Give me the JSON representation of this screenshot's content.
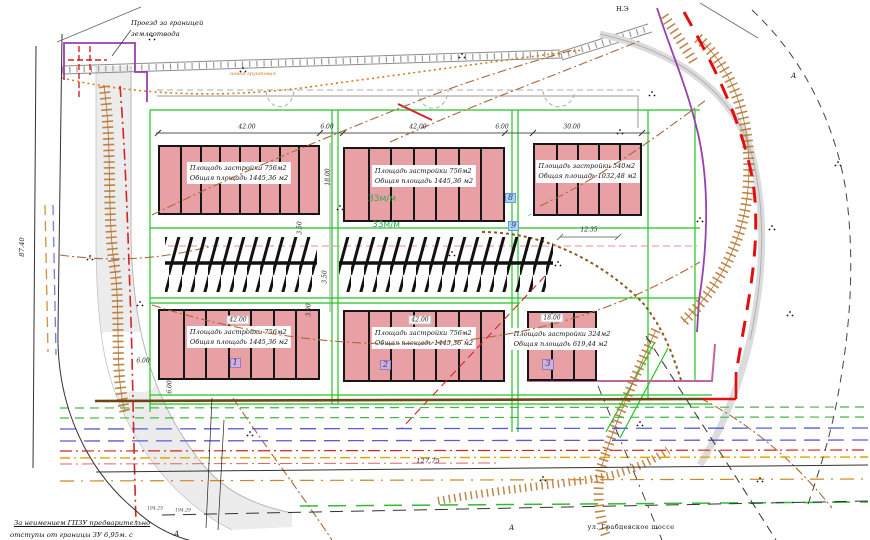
{
  "labels": {
    "top_left_note_line1": "Проезд за границей",
    "top_left_note_line2": "землеотвода",
    "bottom_left_note_line1": "За неимением ГПЗУ предварительно",
    "bottom_left_note_line2": "отступы от границы ЗУ 6,95м. с",
    "street": "ул. Грабцевское шоссе",
    "parking_capacity_1": "33м/м",
    "parking_capacity_2": "33м/м",
    "new_road": "новая грунтовая",
    "ne_marker": "Н.Э",
    "marker_a1": "А",
    "marker_a2": "А",
    "marker_a3": "А",
    "node_badge_8": "8",
    "node_badge_9": "9"
  },
  "buildings": [
    {
      "id": "top-left",
      "x": 158,
      "y": 145,
      "w": 162,
      "h": 70,
      "sections": 8,
      "badge": "",
      "badge_left_pct": 0,
      "line1": "Площадь застройки 756м2",
      "line2": "Общая площадь 1445,36 м2"
    },
    {
      "id": "top-middle",
      "x": 343,
      "y": 147,
      "w": 162,
      "h": 75,
      "sections": 7,
      "badge": "",
      "badge_left_pct": 0,
      "line1": "Площадь застройки 756м2",
      "line2": "Общая площадь 1445,36 м2"
    },
    {
      "id": "top-right",
      "x": 533,
      "y": 143,
      "w": 109,
      "h": 73,
      "sections": 5,
      "badge": "",
      "badge_left_pct": 0,
      "line1": "Площадь застройки 540м2",
      "line2": "Общая площадь 1032,48 м2"
    },
    {
      "id": "bottom-left",
      "x": 158,
      "y": 309,
      "w": 162,
      "h": 71,
      "sections": 7,
      "badge": "1",
      "badge_left_pct": 44,
      "line1": "Площадь застройки 756м2",
      "line2": "Общая площадь 1445,36 м2"
    },
    {
      "id": "bottom-middle",
      "x": 343,
      "y": 310,
      "w": 162,
      "h": 72,
      "sections": 7,
      "badge": "2",
      "badge_left_pct": 22,
      "line1": "Площадь застройки 756м2",
      "line2": "Общая площадь 1445,36 м2"
    },
    {
      "id": "bottom-right",
      "x": 527,
      "y": 311,
      "w": 70,
      "h": 70,
      "sections": 3,
      "badge": "3",
      "badge_left_pct": 20,
      "line1": "Площадь застройки 324м2",
      "line2": "Общая площадь 619,44 м2"
    }
  ],
  "dims": [
    {
      "text": "42.00",
      "x": 247,
      "y": 127,
      "cls": ""
    },
    {
      "text": "6.00",
      "x": 327,
      "y": 127,
      "cls": ""
    },
    {
      "text": "42.00",
      "x": 418,
      "y": 127,
      "cls": ""
    },
    {
      "text": "6.00",
      "x": 502,
      "y": 127,
      "cls": ""
    },
    {
      "text": "30.00",
      "x": 572,
      "y": 127,
      "cls": ""
    },
    {
      "text": "42.00",
      "x": 238,
      "y": 320,
      "cls": "box"
    },
    {
      "text": "42.00",
      "x": 420,
      "y": 320,
      "cls": "box"
    },
    {
      "text": "18.00",
      "x": 552,
      "y": 318,
      "cls": "box"
    },
    {
      "text": "12.35",
      "x": 589,
      "y": 230,
      "cls": ""
    },
    {
      "text": "18.00",
      "x": 328,
      "y": 177,
      "cls": "rot"
    },
    {
      "text": "3.50",
      "x": 300,
      "y": 228,
      "cls": "rot"
    },
    {
      "text": "3.50",
      "x": 325,
      "y": 277,
      "cls": "rot"
    },
    {
      "text": "3.00",
      "x": 309,
      "y": 310,
      "cls": "rot"
    },
    {
      "text": "6.00",
      "x": 143,
      "y": 361,
      "cls": ""
    },
    {
      "text": "6.00",
      "x": 170,
      "y": 387,
      "cls": "rot"
    },
    {
      "text": "87.40",
      "x": 22,
      "y": 247,
      "cls": "rot big"
    },
    {
      "text": "127.75",
      "x": 428,
      "y": 461,
      "cls": "big"
    },
    {
      "text": "194.25",
      "x": 155,
      "y": 509,
      "cls": "tiny"
    },
    {
      "text": "194.29",
      "x": 183,
      "y": 511,
      "cls": "tiny"
    }
  ],
  "colors": {
    "building_fill": "#e9a0a5",
    "boundary_green": "#22c522",
    "boundary_purple": "#9a3fb0",
    "boundary_pink": "#c2679e",
    "slope_orange": "#b5722d",
    "contour_brown": "#a9683a",
    "utility_blue": "#5b5bd6",
    "utility_red": "#d42323",
    "utility_green": "#46b546",
    "utility_yellow": "#e2a400",
    "road_gray": "#ececec"
  }
}
